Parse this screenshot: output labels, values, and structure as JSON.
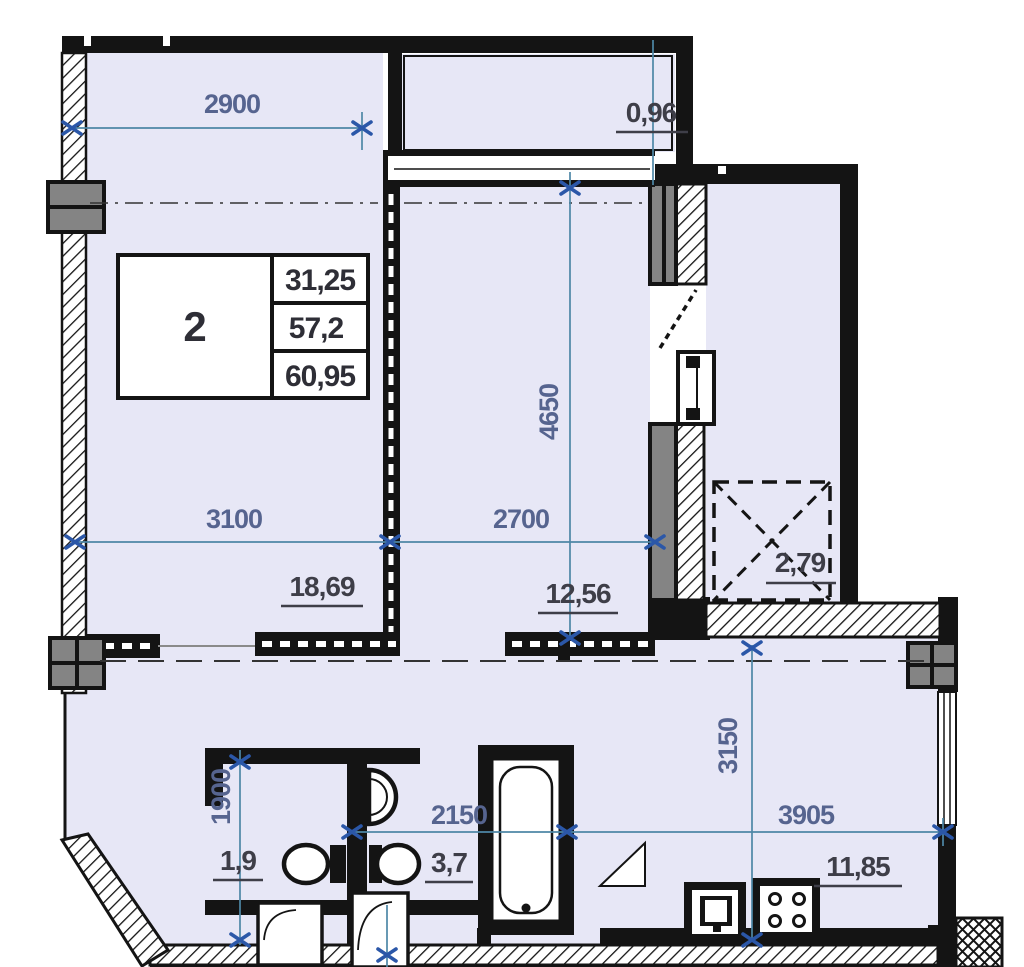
{
  "plan": {
    "legend": {
      "flat_number": "2",
      "area_rows": [
        "31,25",
        "57,2",
        "60,95"
      ]
    },
    "dimensions": {
      "d2900": "2900",
      "d3100": "3100",
      "d2700": "2700",
      "d4650": "4650",
      "d1900": "1900",
      "d2150": "2150",
      "d3905": "3905",
      "d3150": "3150"
    },
    "areas": {
      "balcony": "0,96",
      "bedroom": "18,69",
      "living": "12,56",
      "closet": "2,79",
      "wc": "1,9",
      "bathroom": "3,7",
      "kitchen": "11,85"
    },
    "colors": {
      "room_fill": "#e7e7f6",
      "wall": "#141414",
      "column_gray": "#848484",
      "dimension_line": "#4e87a6",
      "dimension_marker": "#2b57a8",
      "dimension_text": "#56648f",
      "area_text": "#3e3e48"
    }
  }
}
